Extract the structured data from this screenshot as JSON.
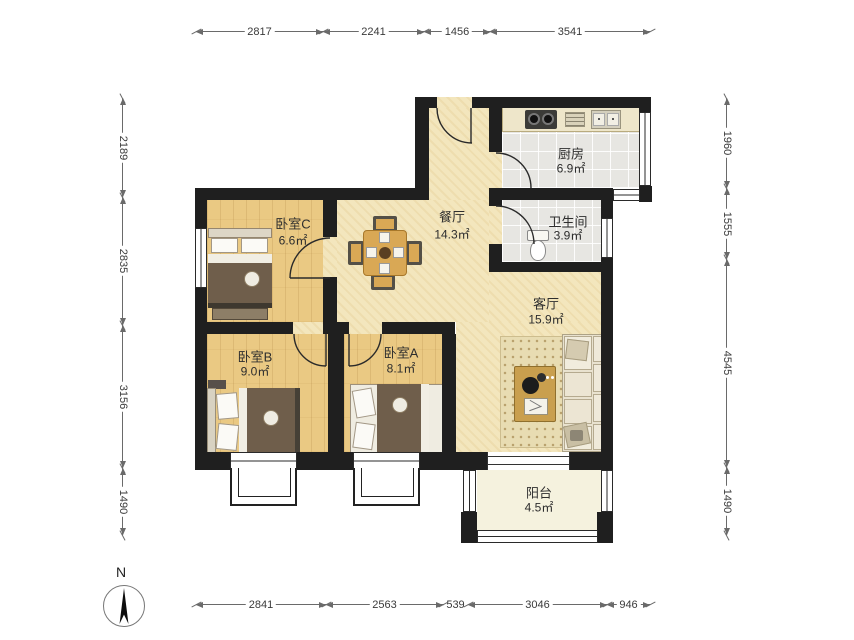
{
  "compass": {
    "label": "N"
  },
  "rooms": [
    {
      "id": "bedroomC",
      "name": "卧室C",
      "area": "6.6㎡"
    },
    {
      "id": "dining",
      "name": "餐厅",
      "area": "14.3㎡"
    },
    {
      "id": "kitchen",
      "name": "厨房",
      "area": "6.9㎡"
    },
    {
      "id": "bath",
      "name": "卫生间",
      "area": "3.9㎡"
    },
    {
      "id": "living",
      "name": "客厅",
      "area": "15.9㎡"
    },
    {
      "id": "bedroomB",
      "name": "卧室B",
      "area": "9.0㎡"
    },
    {
      "id": "bedroomA",
      "name": "卧室A",
      "area": "8.1㎡"
    },
    {
      "id": "balcony",
      "name": "阳台",
      "area": "4.5㎡"
    }
  ],
  "dimensions": {
    "top": {
      "labels": [
        "2817",
        "2241",
        "1456",
        "3541"
      ]
    },
    "bottom": {
      "labels": [
        "2841",
        "2563",
        "539",
        "3046",
        "946"
      ]
    },
    "left": {
      "labels": [
        "2189",
        "2835",
        "3156",
        "1490"
      ]
    },
    "right": {
      "labels": [
        "1960",
        "1555",
        "4545",
        "1490"
      ]
    }
  }
}
